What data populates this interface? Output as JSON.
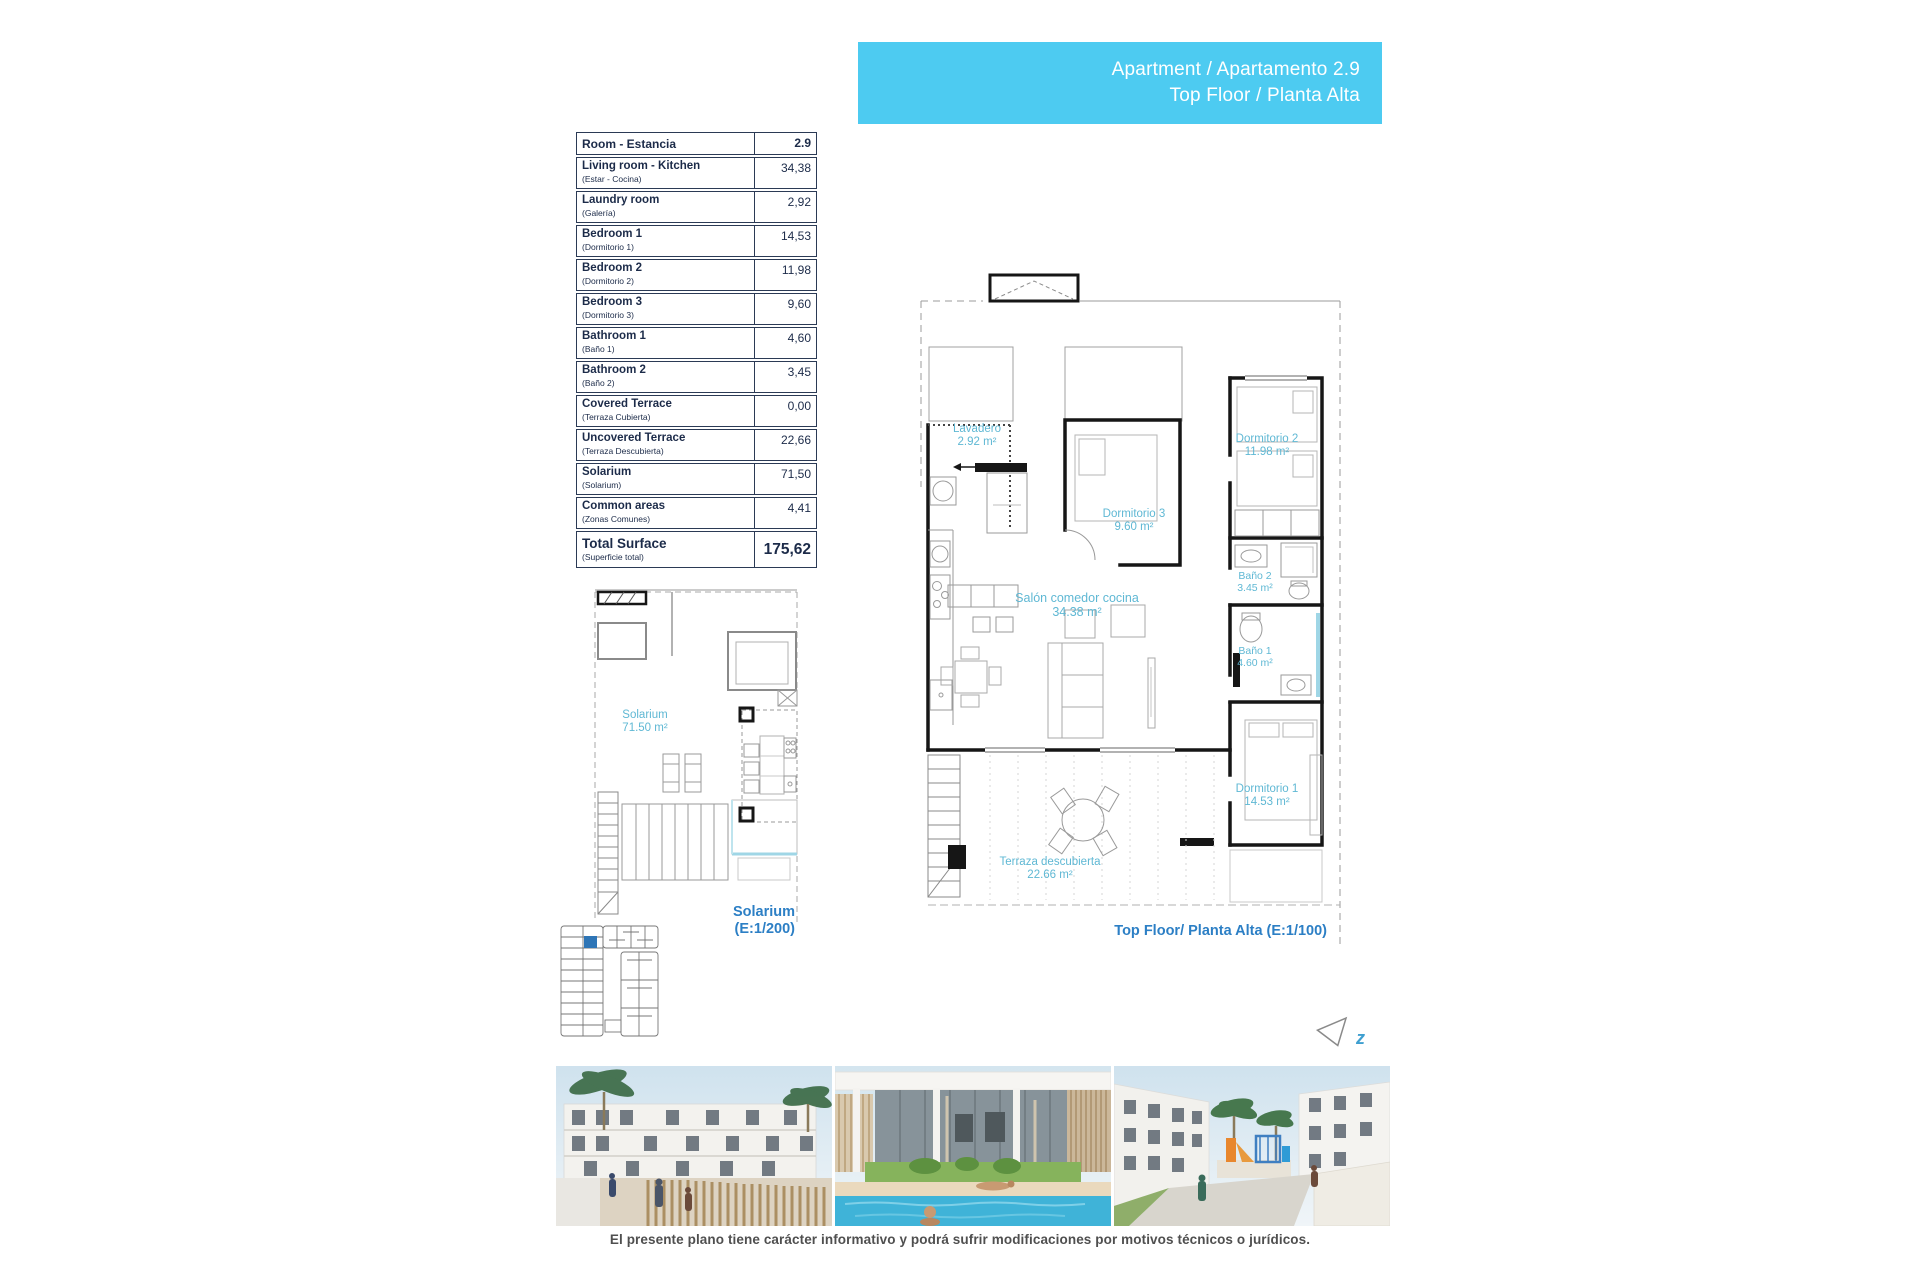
{
  "colors": {
    "banner_bg": "#4dcbf1",
    "banner_text": "#ffffff",
    "room_label": "#5fb8d4",
    "plan_caption": "#2c7fc5",
    "table_text": "#1c2b49",
    "highlight_unit": "#2e75b6",
    "wall": "#161616",
    "shower_accent": "#9fd6e6"
  },
  "banner": {
    "line1": "Apartment / Apartamento 2.9",
    "line2": "Top Floor / Planta Alta"
  },
  "area_table": {
    "header_room": "Room - Estancia",
    "header_value": "2.9",
    "rows": [
      {
        "en": "Living room - Kitchen",
        "es": "(Estar - Cocina)",
        "value": "34,38"
      },
      {
        "en": "Laundry room",
        "es": "(Galería)",
        "value": "2,92"
      },
      {
        "en": "Bedroom 1",
        "es": "(Dormitorio 1)",
        "value": "14,53"
      },
      {
        "en": "Bedroom 2",
        "es": "(Dormitorio 2)",
        "value": "11,98"
      },
      {
        "en": "Bedroom 3",
        "es": "(Dormitorio 3)",
        "value": "9,60"
      },
      {
        "en": "Bathroom 1",
        "es": "(Baño 1)",
        "value": "4,60"
      },
      {
        "en": "Bathroom 2",
        "es": "(Baño 2)",
        "value": "3,45"
      },
      {
        "en": "Covered Terrace",
        "es": "(Terraza Cubierta)",
        "value": "0,00"
      },
      {
        "en": "Uncovered Terrace",
        "es": "(Terraza Descubierta)",
        "value": "22,66"
      },
      {
        "en": "Solarium",
        "es": "(Solarium)",
        "value": "71,50"
      },
      {
        "en": "Common areas",
        "es": "(Zonas Comunes)",
        "value": "4,41"
      }
    ],
    "total_en": "Total Surface",
    "total_es": "(Superficie total)",
    "total_value": "175,62"
  },
  "floor_plan": {
    "caption": "Top Floor/ Planta Alta (E:1/100)",
    "labels": {
      "lavadero": {
        "name": "Lavadero",
        "area": "2.92 m²"
      },
      "dormitorio3": {
        "name": "Dormitorio 3",
        "area": "9.60 m²"
      },
      "dormitorio2": {
        "name": "Dormitorio 2",
        "area": "11.98 m²"
      },
      "bano2": {
        "name": "Baño 2",
        "area": "3.45 m²"
      },
      "bano1": {
        "name": "Baño 1",
        "area": "4.60 m²"
      },
      "salon": {
        "name": "Salón comedor cocina",
        "area": "34.38 m²"
      },
      "dormitorio1": {
        "name": "Dormitorio 1",
        "area": "14.53 m²"
      },
      "terraza": {
        "name": "Terraza descubierta",
        "area": "22.66 m²"
      }
    }
  },
  "solarium_plan": {
    "label": {
      "name": "Solarium",
      "area": "71.50 m²"
    },
    "caption_line1": "Solarium",
    "caption_line2": "(E:1/200)"
  },
  "north_arrow": {
    "label": "z"
  },
  "footer": {
    "disclaimer": "El presente plano tiene carácter informativo y podrá sufrir modificaciones por motivos técnicos o jurídicos."
  }
}
